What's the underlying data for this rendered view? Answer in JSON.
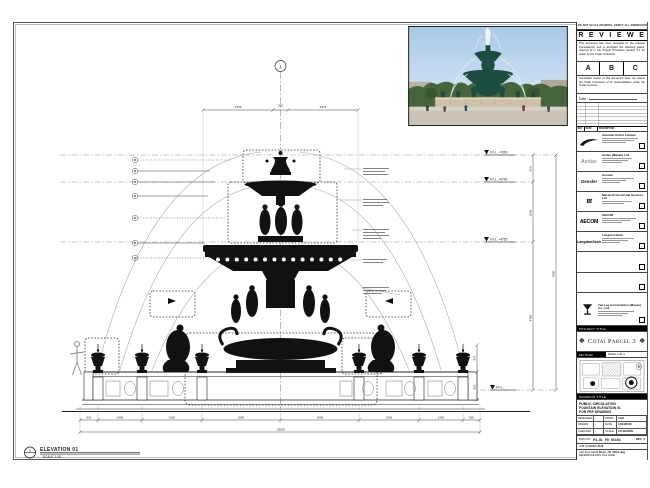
{
  "stamp": {
    "top_note": "DO NOT SCALE DRAWING. VERIFY ALL DIMENSIONS ON SITE.",
    "title": "R E V I E W E D",
    "para1": "This document has been reviewed by the relevant Consultant(s) and is accorded the following status, referred to in the Project Procedure Section 5.4 for action by the Trade Contractor.",
    "grades": [
      "A",
      "B",
      "C"
    ],
    "para2": "Consultant review of this document does not relieve the Trade Contractor of its responsibilities under the Trade Contract.",
    "date_label": "Date :"
  },
  "revision_header": [
    "REV",
    "DATE",
    "DESCRIPTION"
  ],
  "consultants": [
    {
      "name": "Venetian Orient Limited"
    },
    {
      "logo_text": "Aedas",
      "name": "Aedas (Macau) Ltd."
    },
    {
      "logo_text": "Gensler",
      "name": "Gensler"
    },
    {
      "logo_text": "ttt",
      "name": "Macau Professional Services Ltd."
    },
    {
      "logo_text": "AECOM",
      "name": "AECOM"
    },
    {
      "logo_text": "LangdonSeah",
      "name": "Langdon Seah"
    }
  ],
  "contractor": {
    "name": "Yau Lee Construction (Macau) Co., Ltd."
  },
  "project": {
    "title_label": "PROJECT TITLE",
    "name": "Cotai Parcel 3",
    "ornament": "❖"
  },
  "key_plan": {
    "label": "KEY PLAN",
    "note": "PANEL 1 OF 4"
  },
  "title_block": {
    "drawing_title_label": "DRAWING TITLE",
    "title_lines": [
      "PUBLIC CIRCULATION",
      "FOUNTAIN ELEVATION 01",
      "FOR FRP DRAWING"
    ],
    "rows": [
      {
        "l": "DESIGNED",
        "lv": "-",
        "r": "DRWN",
        "rv": "CAD"
      },
      {
        "l": "DRAWN",
        "lv": "-",
        "r": "DATE",
        "rv": "12/04/2016"
      },
      {
        "l": "CHECKED",
        "lv": "-",
        "r": "SCALE",
        "rv": "AS SHOWN"
      }
    ],
    "dwg_no_label": "DWG NO.",
    "dwg_no": "P3-GL_FD_05101",
    "rev_label": "REV",
    "rev": "0",
    "job_label": "JOB NUMBER",
    "job": "3123",
    "cad_label": "CAD FILE NAME",
    "cad": "P3-GL_FD_05101.dwg",
    "ref_label": "REFERENCE DWG FILE NAME"
  },
  "drawing": {
    "grid_bubble": "1",
    "elevation_bubble": "1",
    "elevation_title": "ELEVATION 01",
    "elevation_scale": "SCALE 1:25",
    "levels": {
      "l1": "F.F.L. +7600",
      "l2": "F.F.L. +6790",
      "l3": "F.F.L. +4750",
      "ground": "F.F.L."
    },
    "vdims": {
      "d1": "810",
      "d2": "2040",
      "d3": "4750",
      "overall": "7600"
    },
    "top_dims": {
      "left": "2375",
      "center": "250",
      "right": "2375"
    },
    "bottom_dims": [
      "600",
      "1400",
      "1900",
      "2600",
      "2600",
      "1900",
      "1400",
      "600"
    ],
    "bottom_overall": "13000",
    "side_vdims": {
      "a": "875",
      "b": "900"
    }
  }
}
